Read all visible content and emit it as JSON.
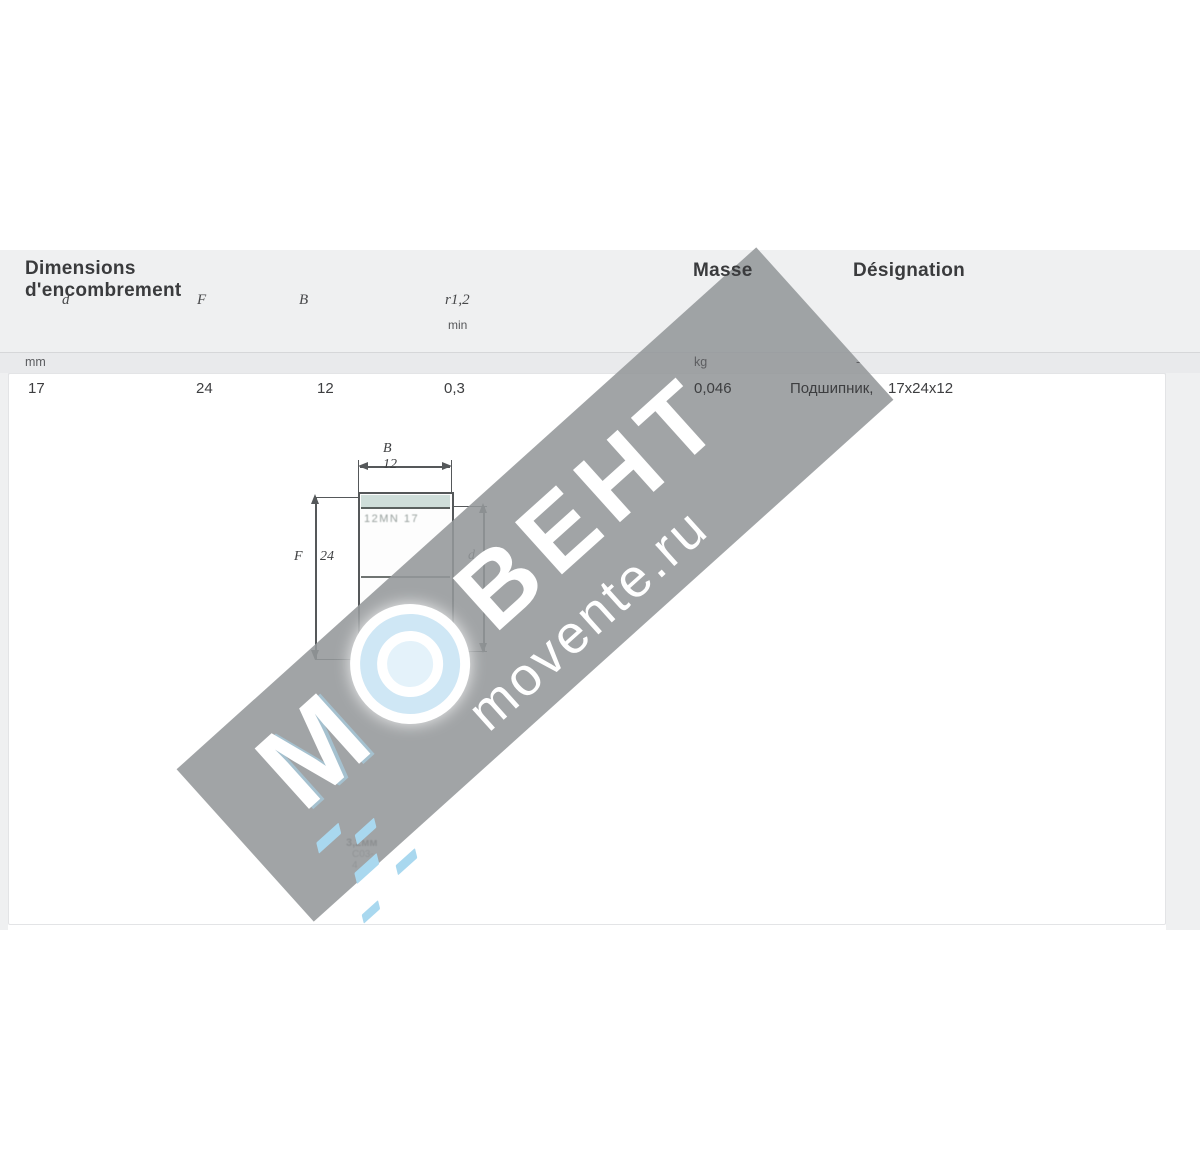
{
  "table": {
    "group_header": "Dimensions d'encombrement",
    "mass_header": "Masse",
    "designation_header": "Désignation",
    "symbols": [
      "d",
      "F",
      "B",
      "r1,2"
    ],
    "symbol_sub": "min",
    "units": {
      "dimensions": "mm",
      "mass": "kg",
      "designation": "-"
    },
    "row": {
      "d": "17",
      "F": "24",
      "B": "12",
      "r": "0,3",
      "mass": "0,046",
      "designation_name": "Подшипник,",
      "designation_dims": "17х24х12"
    }
  },
  "drawing": {
    "width_label": "B 12",
    "left_symbol": "F",
    "left_value": "24",
    "right_symbol": "d",
    "right_value": "17",
    "stamp": "12MN 17",
    "note1": "3,2мм",
    "note2": "С03-4"
  },
  "watermark": {
    "letter": "М",
    "brand": "ВЕНТ",
    "site": "movente.ru",
    "band_color": "#96989b",
    "accent_blue": "#a9d8ef",
    "text_color": "#ffffff"
  }
}
